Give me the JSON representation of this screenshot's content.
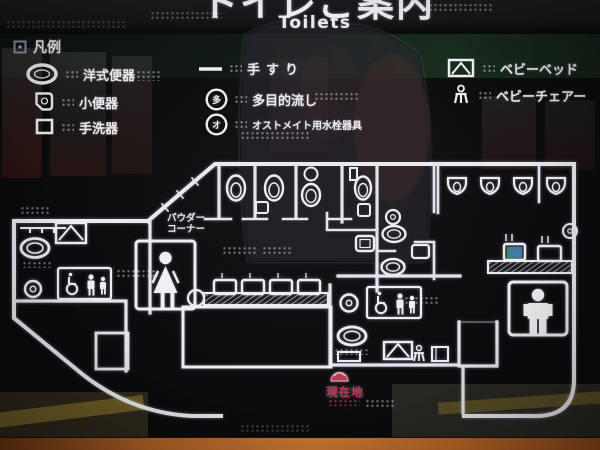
{
  "header": {
    "title_ja": "トイレご案内",
    "title_en": "Toilets"
  },
  "legend": {
    "title": "凡例",
    "items_left": [
      {
        "icon": "western-toilet-icon",
        "label": "洋式便器"
      },
      {
        "icon": "urinal-icon",
        "label": "小便器"
      },
      {
        "icon": "hand-wash-basin-icon",
        "label": "手洗器"
      }
    ],
    "items_middle": [
      {
        "icon": "handrail-icon",
        "label": "手すり"
      },
      {
        "icon": "multi-purpose-sink-icon",
        "label": "多目的流し",
        "glyph": "多"
      },
      {
        "icon": "ostomate-fixture-icon",
        "label": "オストメイト用水栓器具",
        "glyph": "オ"
      }
    ],
    "items_right": [
      {
        "icon": "baby-bed-icon",
        "label": "ベビーベッド"
      },
      {
        "icon": "baby-chair-icon",
        "label": "ベビーチェアー"
      }
    ]
  },
  "map": {
    "powder_corner_line1": "パウダー",
    "powder_corner_line2": "コーナー",
    "current_location_label": "現在地"
  },
  "colors": {
    "line": "#e9e9ee",
    "background": "#0c0c0e",
    "current_location_red": "#bd3750",
    "frame_orange": "#c06a28"
  }
}
